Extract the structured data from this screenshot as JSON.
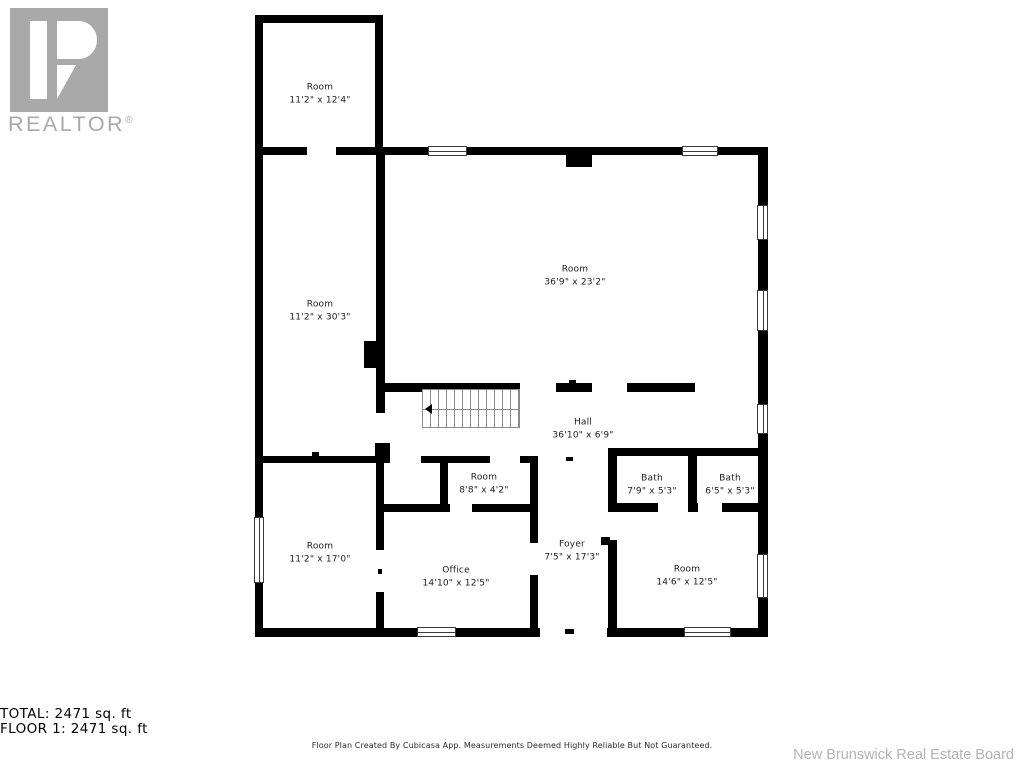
{
  "branding": {
    "logo_word": "REALTOR",
    "registered_mark": "®",
    "logo_color": "#a9a9a9"
  },
  "rooms": [
    {
      "name": "Room",
      "dims": "11'2\" x 12'4\""
    },
    {
      "name": "Room",
      "dims": "11'2\" x 30'3\""
    },
    {
      "name": "Room",
      "dims": "36'9\" x 23'2\""
    },
    {
      "name": "Hall",
      "dims": "36'10\" x 6'9\""
    },
    {
      "name": "Room",
      "dims": "8'8\" x 4'2\""
    },
    {
      "name": "Bath",
      "dims": "7'9\" x 5'3\""
    },
    {
      "name": "Bath",
      "dims": "6'5\" x 5'3\""
    },
    {
      "name": "Room",
      "dims": "11'2\" x 17'0\""
    },
    {
      "name": "Office",
      "dims": "14'10\" x 12'5\""
    },
    {
      "name": "Foyer",
      "dims": "7'5\" x 17'3\""
    },
    {
      "name": "Room",
      "dims": "14'6\" x 12'5\""
    }
  ],
  "summary": {
    "total_line": "TOTAL: 2471 sq. ft",
    "floor_line": "FLOOR 1: 2471 sq. ft",
    "disclaimer": "Floor Plan Created By Cubicasa App. Measurements Deemed Highly Reliable But Not Guaranteed."
  },
  "attribution": {
    "text": "New Brunswick Real Estate Board"
  },
  "colors": {
    "wall": "#000000",
    "label_text": "#1c1c1c",
    "stairs_line": "#8a8a8a",
    "attribution_gray": "#b4b4b4"
  }
}
